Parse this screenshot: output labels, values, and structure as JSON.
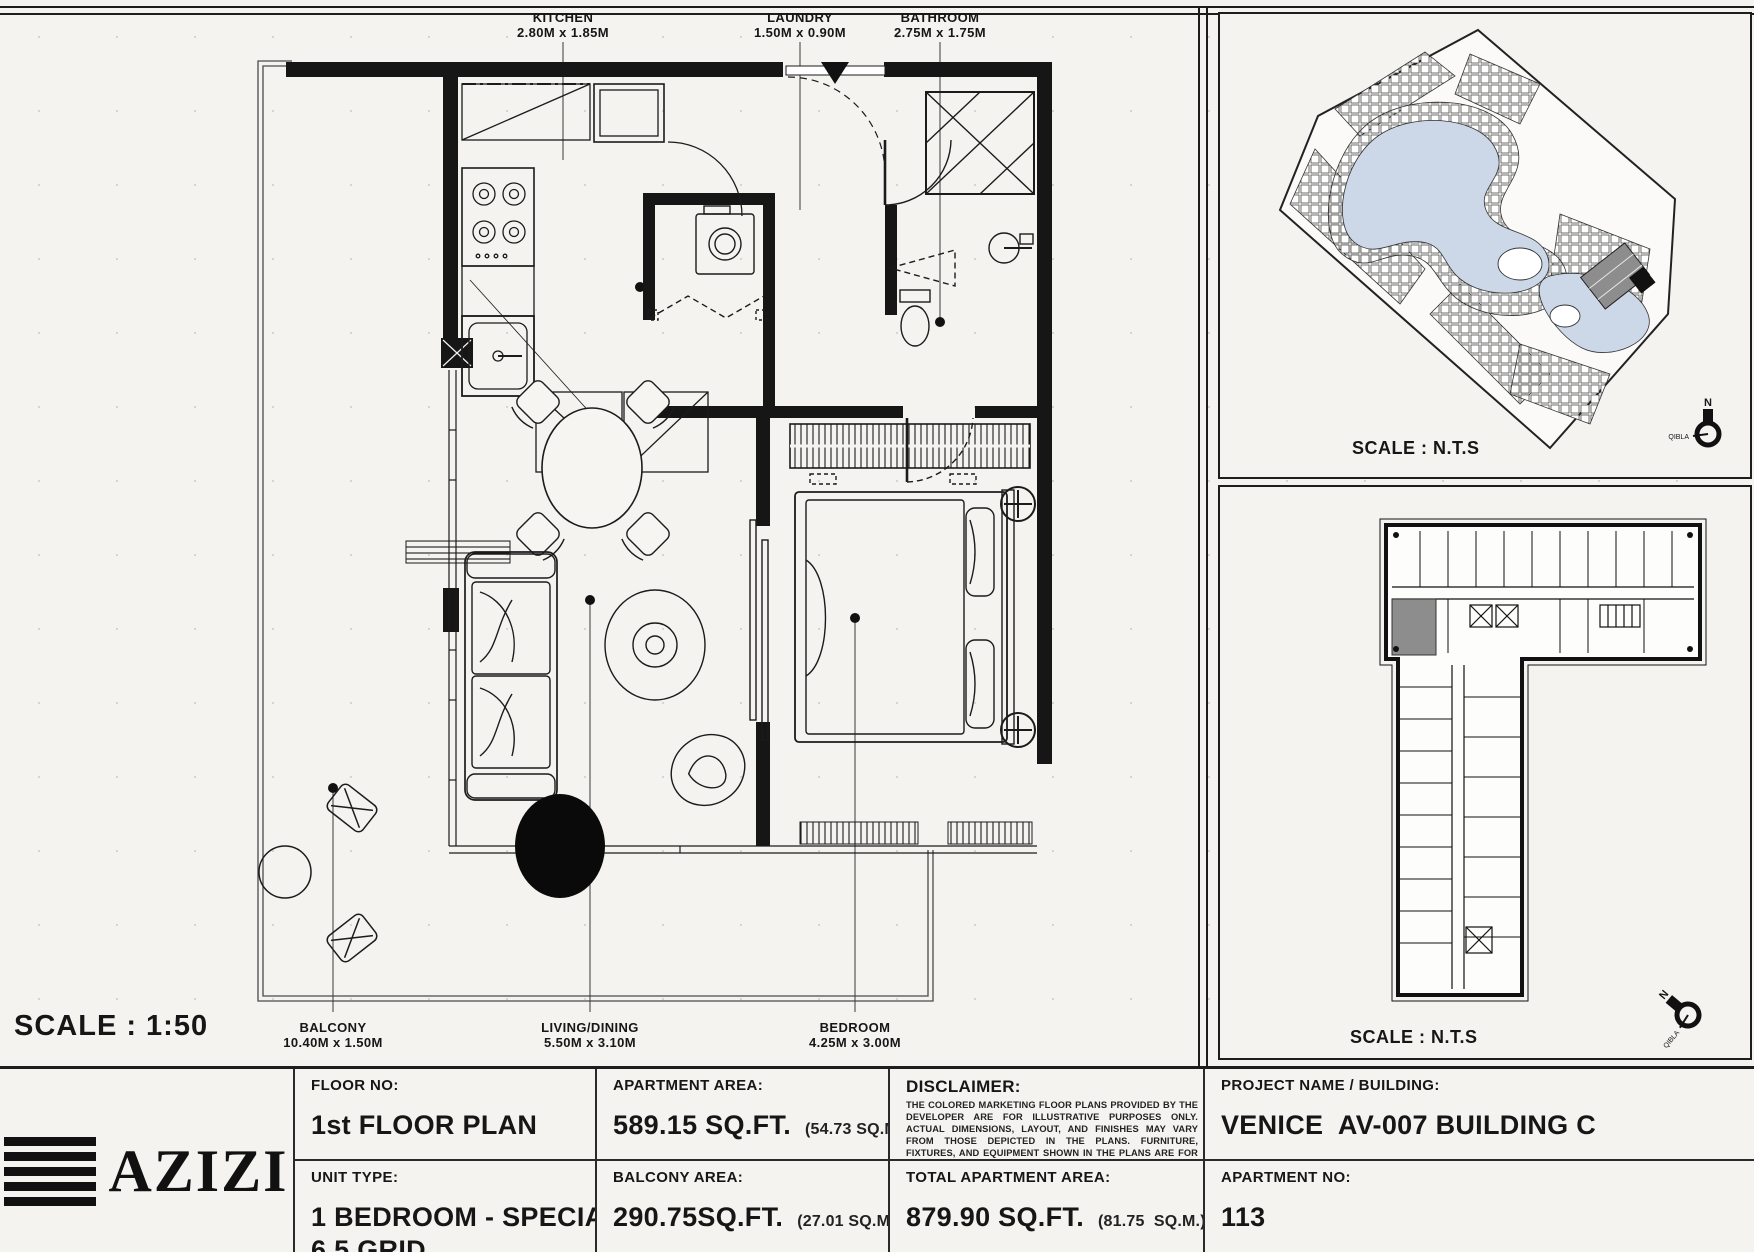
{
  "sheet": {
    "scale_label": "SCALE : 1:50"
  },
  "floor_plan": {
    "labels": {
      "kitchen": {
        "name": "KITCHEN",
        "dims": "2.80M x 1.85M"
      },
      "laundry": {
        "name": "LAUNDRY",
        "dims": "1.50M x 0.90M"
      },
      "bathroom": {
        "name": "BATHROOM",
        "dims": "2.75M x 1.75M"
      },
      "balcony": {
        "name": "BALCONY",
        "dims": "10.40M x 1.50M"
      },
      "living_dining": {
        "name": "LIVING/DINING",
        "dims": "5.50M x 3.10M"
      },
      "bedroom": {
        "name": "BEDROOM",
        "dims": "4.25M x 3.00M"
      }
    }
  },
  "site_plan": {
    "scale_label": "SCALE : N.T.S",
    "north_label": "N",
    "qibla_label": "QIBLA"
  },
  "key_plan": {
    "scale_label": "SCALE : N.T.S",
    "north_label": "N",
    "qibla_label": "QIBLA"
  },
  "title_block": {
    "brand": "AZIZI",
    "floor_no": {
      "label": "FLOOR NO:",
      "value": "1st FLOOR PLAN"
    },
    "unit_type": {
      "label": "UNIT TYPE:",
      "value_line1": "1 BEDROOM - SPECIAL 04",
      "value_line2": "6.5 GRID"
    },
    "apartment_area": {
      "label": "APARTMENT AREA:",
      "value": "589.15 SQ.FT.",
      "note": "(54.73 SQ.M.)"
    },
    "balcony_area": {
      "label": "BALCONY AREA:",
      "value": "290.75SQ.FT.",
      "note": "(27.01 SQ.M.)"
    },
    "disclaimer": {
      "label": "DISCLAIMER:",
      "text": "THE COLORED MARKETING FLOOR PLANS PROVIDED BY THE DEVELOPER ARE FOR ILLUSTRATIVE PURPOSES ONLY. ACTUAL DIMENSIONS, LAYOUT, AND FINISHES MAY VARY FROM THOSE DEPICTED IN THE PLANS. FURNITURE, FIXTURES, AND EQUIPMENT SHOWN IN THE PLANS ARE FOR DECORATIVE PURPOSES ONLY AND ARE NOT INCLUDED IN THE PURCHASE OR LEASE OF THE PROPERTY. THE DEVELOPER RESERVES THE RIGHT TO MAKE MODIFICATIONS, REVISIONS, AND CHANGES TO THE FLOOR PLANS, SPECIFICATIONS, AND FEATURES WITHOUT PRIOR NOTICE."
    },
    "total_area": {
      "label": "TOTAL APARTMENT AREA:",
      "value": "879.90 SQ.FT.",
      "note": "(81.75  SQ.M.)"
    },
    "project": {
      "label": "PROJECT NAME / BUILDING:",
      "value": "VENICE  AV-007 BUILDING C"
    },
    "apartment_no": {
      "label": "APARTMENT NO:",
      "value": "113"
    }
  },
  "colors": {
    "ink": "#161616",
    "paper": "#f4f3f0",
    "water": "#ccd7e8",
    "highlight_unit": "#8d8d8d"
  }
}
